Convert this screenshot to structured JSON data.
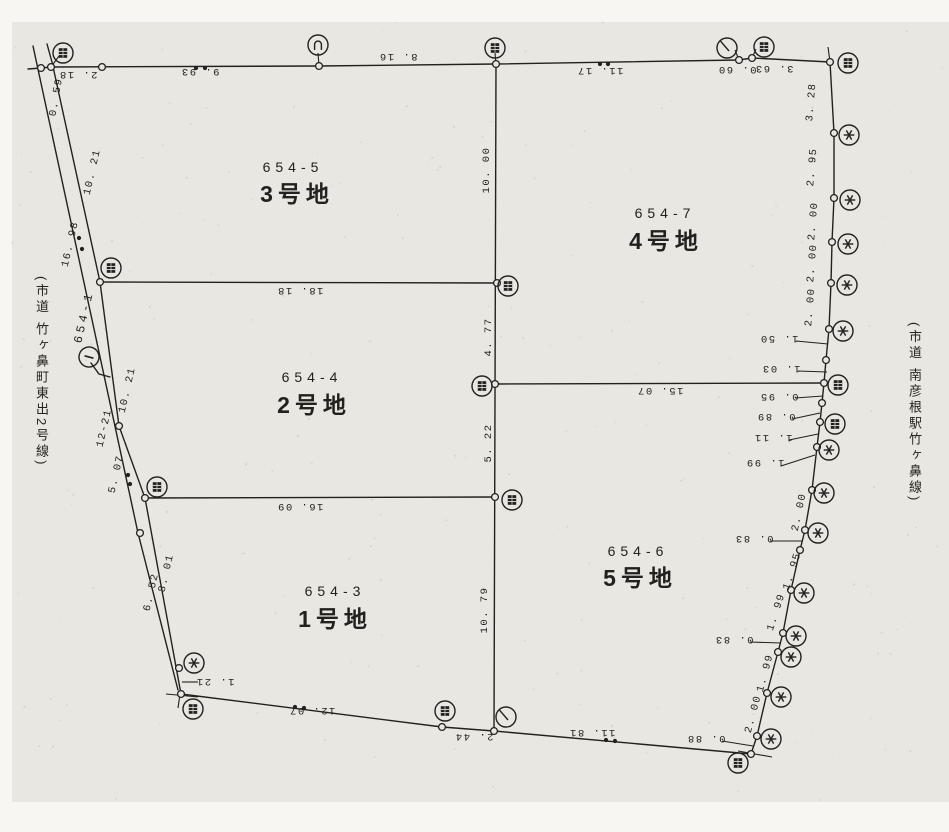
{
  "page": {
    "paper_color": "#e9e7e1",
    "margin_color": "#f7f6f2",
    "line_color": "#23211d",
    "speck_color": "#c9c6bd"
  },
  "roads": {
    "left": "(市道 竹ヶ鼻町東出2号線)",
    "right": "(市道 南彦根駅竹ヶ鼻線)"
  },
  "parcels": [
    {
      "lot": "654-5",
      "name": "3号地",
      "lx": 293,
      "ly": 172,
      "nx": 297,
      "ny": 202
    },
    {
      "lot": "654-7",
      "name": "4号地",
      "lx": 665,
      "ly": 218,
      "nx": 666,
      "ny": 249
    },
    {
      "lot": "654-4",
      "name": "2号地",
      "lx": 312,
      "ly": 382,
      "nx": 314,
      "ny": 413
    },
    {
      "lot": "654-6",
      "name": "5号地",
      "lx": 638,
      "ly": 556,
      "nx": 640,
      "ny": 586
    },
    {
      "lot": "654-3",
      "name": "1号地",
      "lx": 335,
      "ly": 596,
      "nx": 335,
      "ny": 627
    }
  ],
  "adjacent_lot": {
    "label": "654-1",
    "x": 84,
    "y": 317,
    "rot": -77,
    "point_number": "1"
  },
  "dimensions": [
    [
      "2. 18",
      78,
      75,
      180
    ],
    [
      "9. 93",
      200,
      72,
      180
    ],
    [
      "8. 16",
      398,
      57,
      180
    ],
    [
      "11. 17",
      600,
      71,
      180
    ],
    [
      "0. 60",
      737,
      70,
      180
    ],
    [
      "3. 63",
      774,
      69,
      180
    ],
    [
      "0. 59",
      56,
      97,
      -80
    ],
    [
      "10. 21",
      92,
      172,
      -77
    ],
    [
      "16. 98",
      70,
      244,
      -77
    ],
    [
      "10. 21",
      127,
      390,
      -77
    ],
    [
      "12-21",
      104,
      428,
      -77
    ],
    [
      "5. 07",
      116,
      474,
      -77
    ],
    [
      "6. 52",
      151,
      592,
      -77
    ],
    [
      "8. 01",
      166,
      573,
      -77
    ],
    [
      "1. 21",
      215,
      682,
      180
    ],
    [
      "10. 00",
      486,
      170,
      -90
    ],
    [
      "4. 77",
      488,
      337,
      -90
    ],
    [
      "5. 22",
      488,
      443,
      -90
    ],
    [
      "10. 79",
      484,
      610,
      -90
    ],
    [
      "18. 18",
      300,
      291,
      180
    ],
    [
      "16. 09",
      300,
      507,
      180
    ],
    [
      "15. 07",
      660,
      391,
      180
    ],
    [
      "12. 07",
      312,
      711,
      180
    ],
    [
      "2. 44",
      474,
      737,
      180
    ],
    [
      "11. 81",
      592,
      733,
      180
    ],
    [
      "3. 28",
      811,
      102,
      -85
    ],
    [
      "2. 95",
      812,
      167,
      -85
    ],
    [
      "2. 00",
      813,
      221,
      -85
    ],
    [
      "2. 00",
      812,
      263,
      -85
    ],
    [
      "2. 00",
      810,
      307,
      -85
    ],
    [
      "1. 50",
      779,
      339,
      180
    ],
    [
      "1. 03",
      781,
      369,
      180
    ],
    [
      "0. 95",
      779,
      397,
      180
    ],
    [
      "0. 89",
      776,
      417,
      180
    ],
    [
      "1. 11",
      773,
      438,
      180
    ],
    [
      "1. 99",
      765,
      463,
      180
    ],
    [
      "2. 00",
      799,
      512,
      -78
    ],
    [
      "0. 83",
      754,
      539,
      180
    ],
    [
      "1. 95",
      792,
      571,
      -72
    ],
    [
      "1. 99",
      776,
      612,
      -72
    ],
    [
      "0. 83",
      734,
      640,
      180
    ],
    [
      "1. 99",
      765,
      673,
      -75
    ],
    [
      "2. 00",
      753,
      714,
      -75
    ],
    [
      "0. 88",
      706,
      739,
      180
    ]
  ],
  "geometry": {
    "polylines": {
      "top-edge": [
        [
          28,
          69
        ],
        [
          41,
          68
        ],
        [
          51,
          67
        ],
        [
          319,
          66
        ],
        [
          496,
          64
        ],
        [
          739,
          60
        ],
        [
          752,
          58
        ],
        [
          830,
          62
        ]
      ],
      "right-edge": [
        [
          830,
          62
        ],
        [
          834,
          133
        ],
        [
          834,
          198
        ],
        [
          832,
          242
        ],
        [
          831,
          283
        ],
        [
          829,
          329
        ],
        [
          826,
          360
        ],
        [
          824,
          383
        ],
        [
          822,
          403
        ],
        [
          820,
          422
        ],
        [
          817,
          447
        ],
        [
          812,
          490
        ],
        [
          805,
          530
        ],
        [
          800,
          550
        ],
        [
          791,
          590
        ],
        [
          783,
          633
        ],
        [
          778,
          652
        ],
        [
          767,
          693
        ],
        [
          757,
          736
        ],
        [
          751,
          754
        ]
      ],
      "bottom-edge": [
        [
          751,
          754
        ],
        [
          494,
          731
        ],
        [
          442,
          727
        ],
        [
          181,
          694
        ]
      ],
      "road-inner-line": [
        [
          47,
          44
        ],
        [
          52,
          62
        ],
        [
          100,
          282
        ],
        [
          119,
          426
        ],
        [
          145,
          498
        ],
        [
          181,
          694
        ]
      ],
      "road-outer-line": [
        [
          33,
          46
        ],
        [
          36,
          60
        ],
        [
          138,
          533
        ],
        [
          178,
          690
        ]
      ],
      "center-divider": [
        [
          496,
          64
        ],
        [
          494,
          731
        ]
      ],
      "divider-18-18": [
        [
          100,
          282
        ],
        [
          497,
          283
        ]
      ],
      "divider-16-09": [
        [
          145,
          498
        ],
        [
          495,
          497
        ]
      ],
      "divider-15-07": [
        [
          495,
          384
        ],
        [
          824,
          383
        ]
      ],
      "point-leader": [
        [
          91,
          363
        ],
        [
          99,
          374
        ],
        [
          110,
          377
        ]
      ]
    },
    "ticks": [
      [
        796,
        341,
        828,
        344
      ],
      [
        798,
        371,
        827,
        372
      ],
      [
        795,
        398,
        823,
        396
      ],
      [
        792,
        419,
        820,
        413
      ],
      [
        789,
        440,
        818,
        434
      ],
      [
        781,
        466,
        815,
        455
      ],
      [
        770,
        541,
        803,
        541
      ],
      [
        750,
        642,
        781,
        643
      ],
      [
        722,
        741,
        753,
        746
      ],
      [
        182,
        682,
        198,
        682
      ],
      [
        319,
        66,
        318,
        53
      ],
      [
        496,
        64,
        495,
        53
      ],
      [
        739,
        60,
        735,
        50
      ],
      [
        752,
        58,
        756,
        49
      ],
      [
        51,
        67,
        59,
        56
      ],
      [
        166,
        694,
        198,
        697
      ],
      [
        180,
        694,
        178,
        708
      ],
      [
        828,
        47,
        830,
        62
      ],
      [
        738,
        751,
        772,
        757
      ]
    ],
    "vertices": [
      [
        41,
        68
      ],
      [
        51,
        67
      ],
      [
        102,
        67
      ],
      [
        319,
        66
      ],
      [
        496,
        64
      ],
      [
        739,
        60
      ],
      [
        752,
        58
      ],
      [
        830,
        62
      ],
      [
        834,
        133
      ],
      [
        834,
        198
      ],
      [
        832,
        242
      ],
      [
        831,
        283
      ],
      [
        829,
        329
      ],
      [
        826,
        360
      ],
      [
        824,
        383
      ],
      [
        822,
        403
      ],
      [
        820,
        422
      ],
      [
        817,
        447
      ],
      [
        812,
        490
      ],
      [
        805,
        530
      ],
      [
        800,
        550
      ],
      [
        791,
        590
      ],
      [
        783,
        633
      ],
      [
        778,
        652
      ],
      [
        767,
        693
      ],
      [
        757,
        736
      ],
      [
        751,
        754
      ],
      [
        494,
        731
      ],
      [
        442,
        727
      ],
      [
        181,
        694
      ],
      [
        100,
        282
      ],
      [
        119,
        426
      ],
      [
        145,
        498
      ],
      [
        140,
        533
      ],
      [
        179,
        668
      ],
      [
        497,
        283
      ],
      [
        495,
        384
      ],
      [
        495,
        497
      ]
    ],
    "dots": [
      [
        196,
        68
      ],
      [
        205,
        68
      ],
      [
        600,
        64
      ],
      [
        608,
        64
      ],
      [
        79,
        238
      ],
      [
        82,
        249
      ],
      [
        128,
        475
      ],
      [
        130,
        484
      ],
      [
        295,
        707
      ],
      [
        304,
        708
      ],
      [
        606,
        740
      ],
      [
        615,
        741
      ]
    ],
    "symbols": [
      [
        63,
        53,
        "seal",
        0
      ],
      [
        318,
        45,
        "arch",
        0
      ],
      [
        495,
        48,
        "seal",
        0
      ],
      [
        727,
        48,
        "needle",
        0
      ],
      [
        764,
        47,
        "seal",
        0
      ],
      [
        848,
        63,
        "seal",
        0
      ],
      [
        849,
        135,
        "asterisk",
        0
      ],
      [
        850,
        200,
        "asterisk",
        0
      ],
      [
        848,
        244,
        "asterisk",
        0
      ],
      [
        847,
        285,
        "asterisk",
        0
      ],
      [
        843,
        331,
        "asterisk",
        0
      ],
      [
        838,
        385,
        "seal",
        0
      ],
      [
        835,
        424,
        "seal",
        0
      ],
      [
        829,
        450,
        "asterisk",
        0
      ],
      [
        824,
        493,
        "asterisk",
        0
      ],
      [
        818,
        533,
        "asterisk",
        0
      ],
      [
        804,
        593,
        "asterisk",
        0
      ],
      [
        796,
        636,
        "asterisk",
        0
      ],
      [
        791,
        657,
        "asterisk",
        0
      ],
      [
        781,
        697,
        "asterisk",
        0
      ],
      [
        771,
        739,
        "asterisk",
        0
      ],
      [
        738,
        763,
        "seal",
        0
      ],
      [
        111,
        268,
        "seal",
        0
      ],
      [
        508,
        286,
        "seal",
        0
      ],
      [
        482,
        386,
        "seal",
        0
      ],
      [
        157,
        487,
        "seal",
        0
      ],
      [
        512,
        500,
        "seal",
        0
      ],
      [
        506,
        717,
        "needle",
        0
      ],
      [
        445,
        711,
        "seal",
        0
      ],
      [
        194,
        663,
        "asterisk",
        0
      ],
      [
        193,
        709,
        "seal",
        0
      ],
      [
        89,
        357,
        "one",
        -75
      ]
    ]
  }
}
